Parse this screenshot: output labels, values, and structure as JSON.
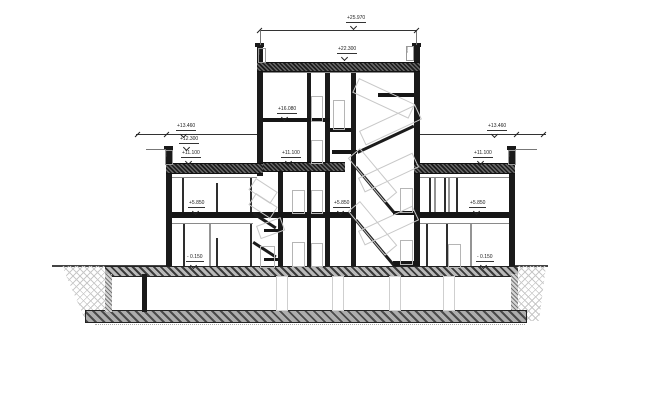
{
  "drawing": {
    "type": "architectural-building-section",
    "background": "#ffffff",
    "line_color": "#1a1a1a",
    "light_outline_color": "#c8c8c8",
    "hatch_color": "#6a6a6a"
  },
  "elevation_labels": [
    {
      "text": "+25.970",
      "location": "overall-top-dimension"
    },
    {
      "text": "+22.300",
      "location": "tower-roof"
    },
    {
      "text": "+16.080",
      "location": "tower-upper-floor"
    },
    {
      "text": "+11.100",
      "location": "tower-mid-floor"
    },
    {
      "text": "+5.850",
      "location": "tower-lower-floor"
    },
    {
      "text": "+13.460",
      "location": "left-wing-parapet-dimension"
    },
    {
      "text": "+12.300",
      "location": "left-wing-parapet"
    },
    {
      "text": "+11.100",
      "location": "left-wing-roof"
    },
    {
      "text": "+5.850",
      "location": "left-wing-floor"
    },
    {
      "text": "- 0.150",
      "location": "left-wing-ground-floor"
    },
    {
      "text": "+13.460",
      "location": "right-wing-parapet-dimension"
    },
    {
      "text": "+11.100",
      "location": "right-wing-roof"
    },
    {
      "text": "+5.850",
      "location": "right-wing-floor"
    },
    {
      "text": "- 0.150",
      "location": "right-wing-ground-floor"
    }
  ],
  "parapet_marks": [
    {
      "text": "600",
      "location": "left-wing-parapet"
    },
    {
      "text": "600",
      "location": "tower-left-parapet"
    },
    {
      "text": "600",
      "location": "tower-right-parapet"
    },
    {
      "text": "600",
      "location": "right-wing-parapet"
    }
  ]
}
